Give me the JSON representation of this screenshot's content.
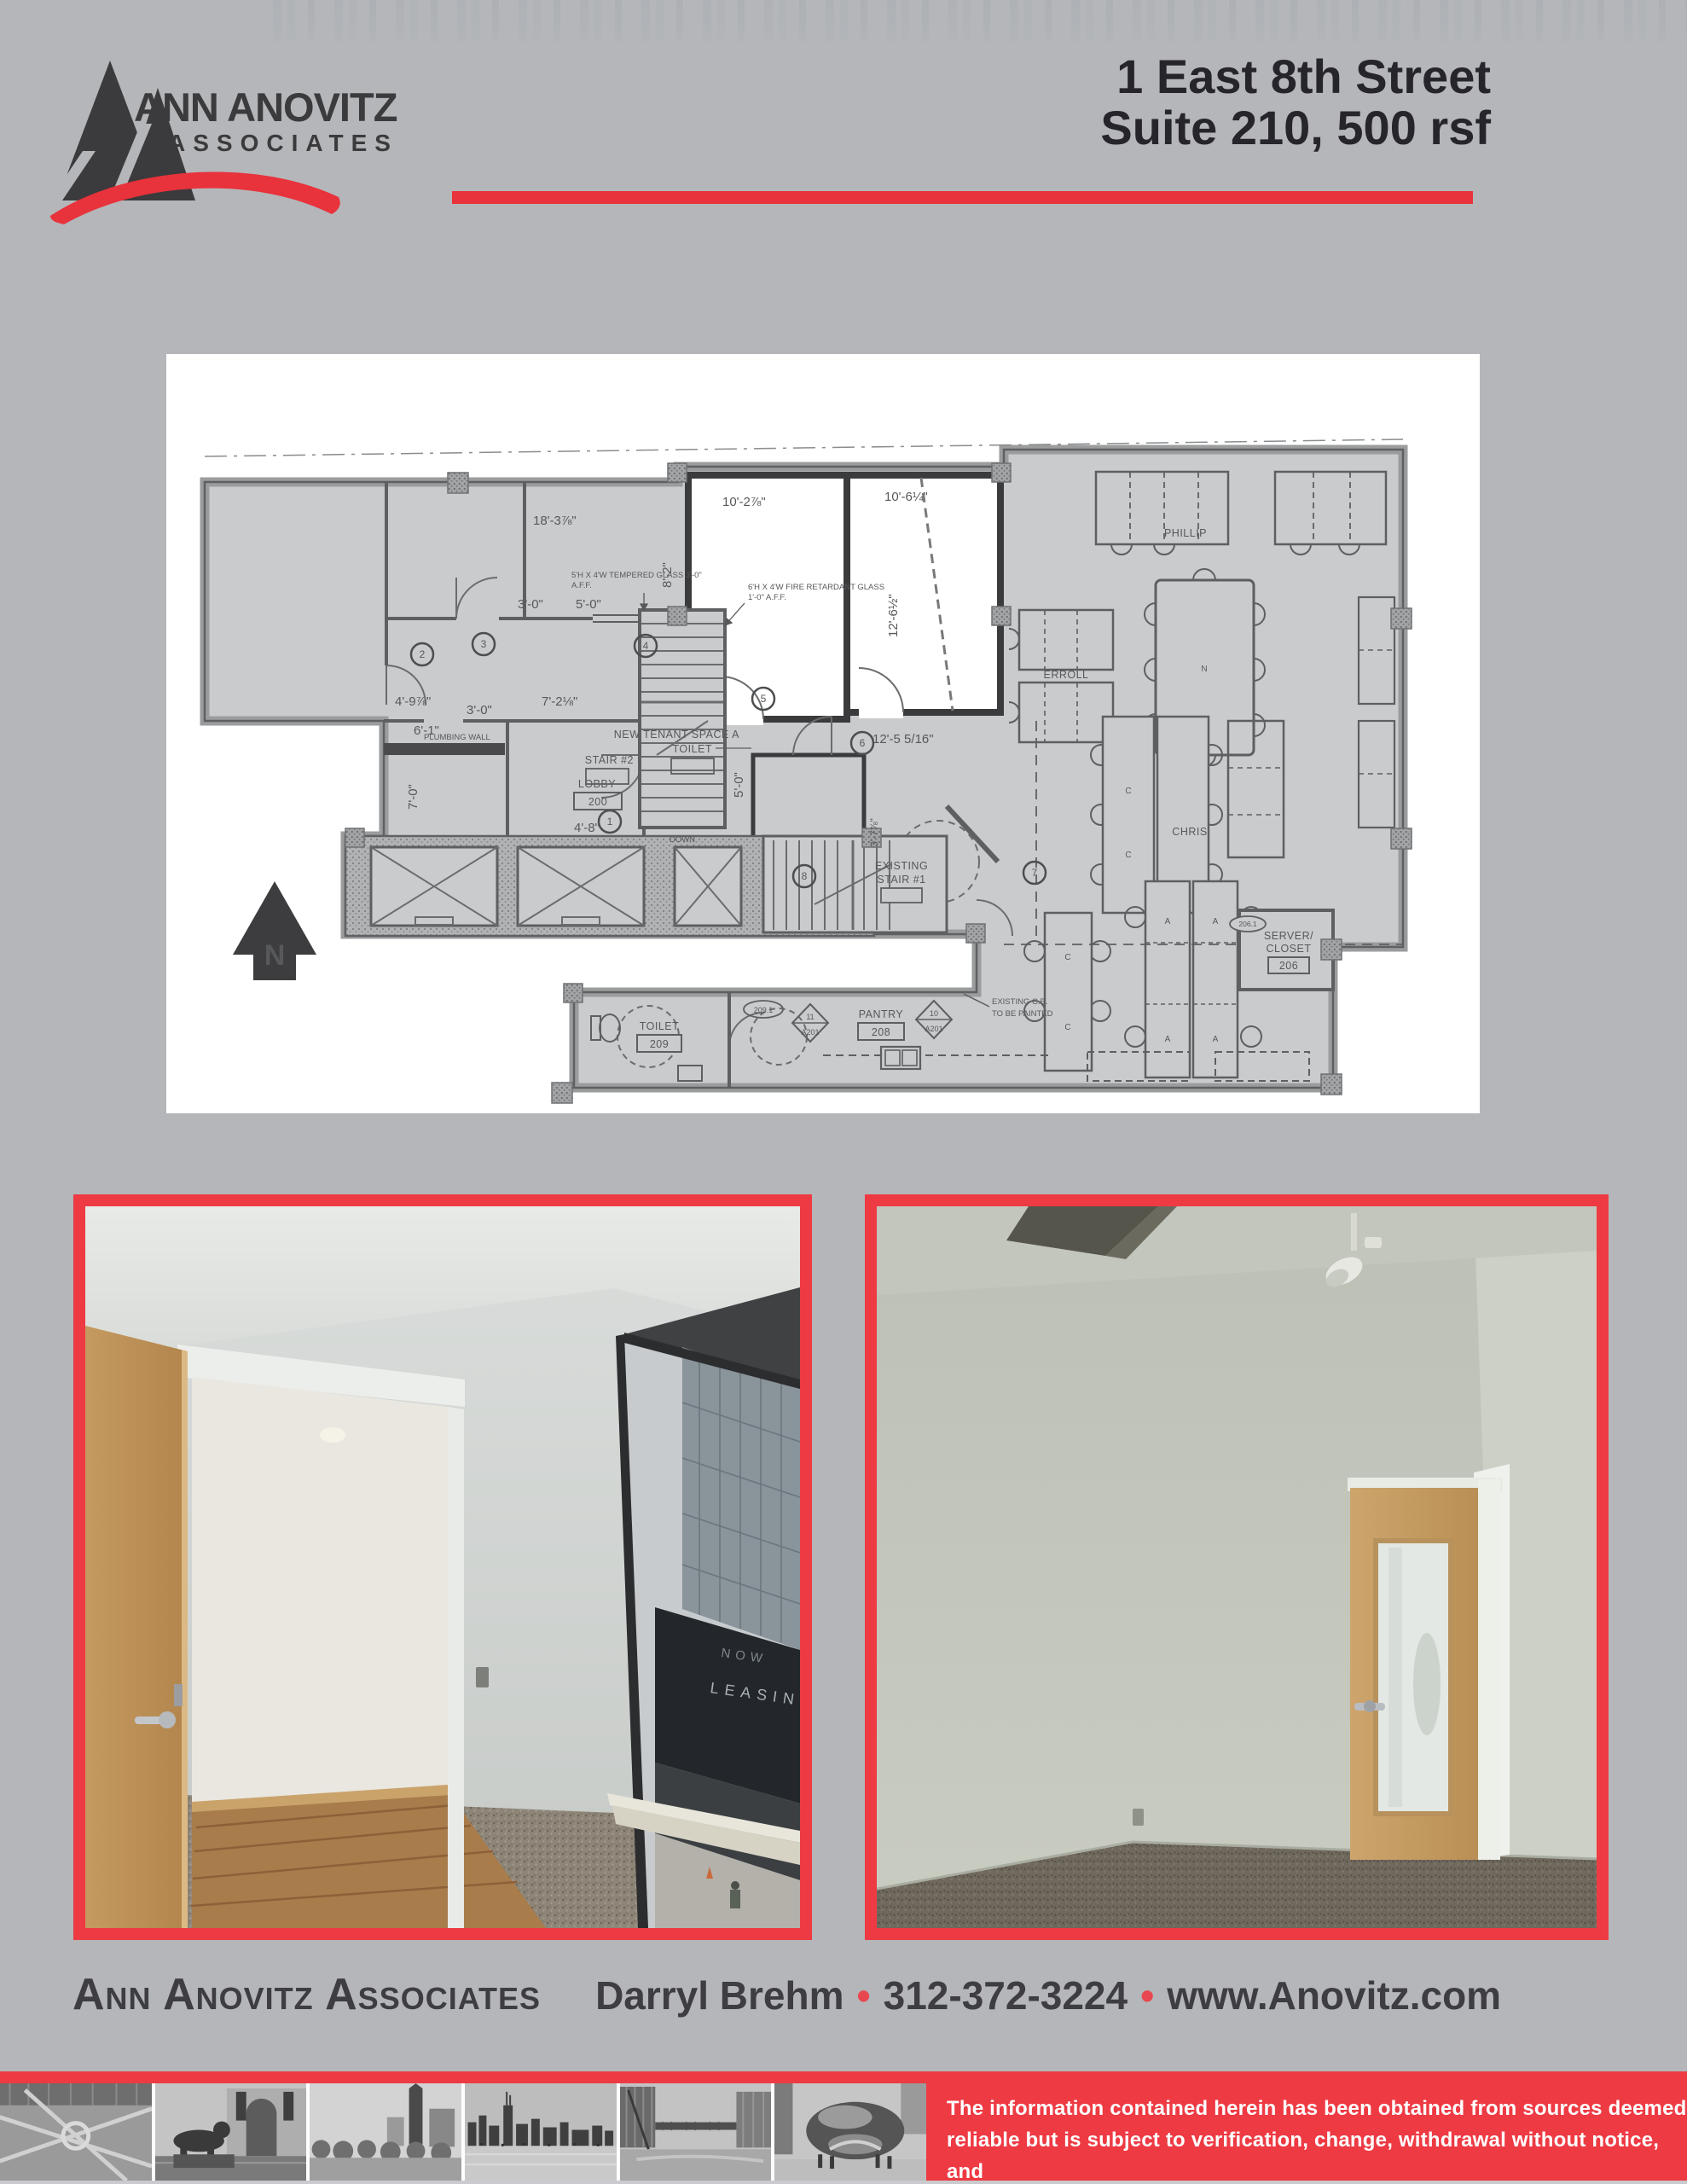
{
  "page": {
    "bg": "#b4b6b9",
    "accent_red": "#ee3a43",
    "swoosh_red": "#e8323c",
    "text_dark": "#3e3d41",
    "title_color": "#26252c"
  },
  "header": {
    "logo_line1": "ANN ANOVITZ",
    "logo_line2": "ASSOCIATES",
    "title_line1": "1 East 8th Street",
    "title_line2": "Suite 210, 500 rsf"
  },
  "floorplan": {
    "north": "N",
    "dims": {
      "d18_3": "18'-3⅞\"",
      "d8_2": "8'-2\"",
      "d3_0a": "3'-0\"",
      "d5_0a": "5'-0\"",
      "d10_2": "10'-2⅞\"",
      "d10_6": "10'-6¼\"",
      "d12_6": "12'-6½\"",
      "d12_5": "12'-5 5/16\"",
      "d4_9": "4'-9⅞\"",
      "d3_0b": "3'-0\"",
      "d7_2": "7'-2⅛\"",
      "d6_1": "6'-1\"",
      "d7_0": "7'-0\"",
      "d4_8": "4'-8\"",
      "d5_0b": "5'-0\"",
      "d3_7": "3'-7⅞\""
    },
    "rooms": {
      "lobby": "LOBBY",
      "lobby_no": "200",
      "stair2": "STAIR #2",
      "down": "DOWN",
      "tenant_line1": "NEW TENANT SPACE A",
      "tenant_line2": "TOILET",
      "stair1_line1": "EXISTING",
      "stair1_line2": "STAIR #1",
      "toilet": "TOILET",
      "toilet_no": "209",
      "toilet_tag": "209.1",
      "detail11": "11",
      "detail11_sheet": "A201",
      "pantry": "PANTRY",
      "pantry_no": "208",
      "detail10": "10",
      "detail10_sheet": "A201",
      "server_line1": "SERVER/",
      "server_line2": "CLOSET",
      "server_no": "206",
      "server_tag": "206.1",
      "phillip": "PHILLIP",
      "erroll": "ERROLL",
      "chris": "CHRIS"
    },
    "notes": {
      "glass1_line1": "5'H X 4'W TEMPERED GLASS 3'-0\"",
      "glass1_line2": "A.F.F.",
      "glass2_line1": "6'H X 4'W FIRE RETARDANT GLASS",
      "glass2_line2": "1'-0\" A.F.F.",
      "plumbing": "PLUMBING WALL",
      "cb_line1": "EXISTING C.B.",
      "cb_line2": "TO BE PAINTED"
    },
    "door_tags": [
      "1",
      "2",
      "3",
      "4",
      "5",
      "6",
      "7",
      "8"
    ]
  },
  "photos": {
    "left_description": "office-room-with-open-door-and-window-city-view",
    "right_description": "office-room-with-wood-frosted-glass-door",
    "window_sign_line1": "NOW",
    "window_sign_line2": "LEASING"
  },
  "footer": {
    "company": "Ann Anovitz Associates",
    "agent": "Darryl Brehm",
    "phone": "312-372-3224",
    "website": "www.Anovitz.com",
    "separator": "•"
  },
  "disclaimer": {
    "line1": "The information contained herein has been obtained from sources deemed",
    "line2": "reliable but is subject to verification, change, withdrawal without notice, and",
    "line3": "is submitted without warranty as to accuracy by Ann Anovitz Associates."
  },
  "strip_photos": [
    "grant-park-aerial",
    "art-institute-lion",
    "park-water-tower",
    "skyline-lakefront",
    "chicago-river-bridge",
    "cloud-gate-bean"
  ]
}
